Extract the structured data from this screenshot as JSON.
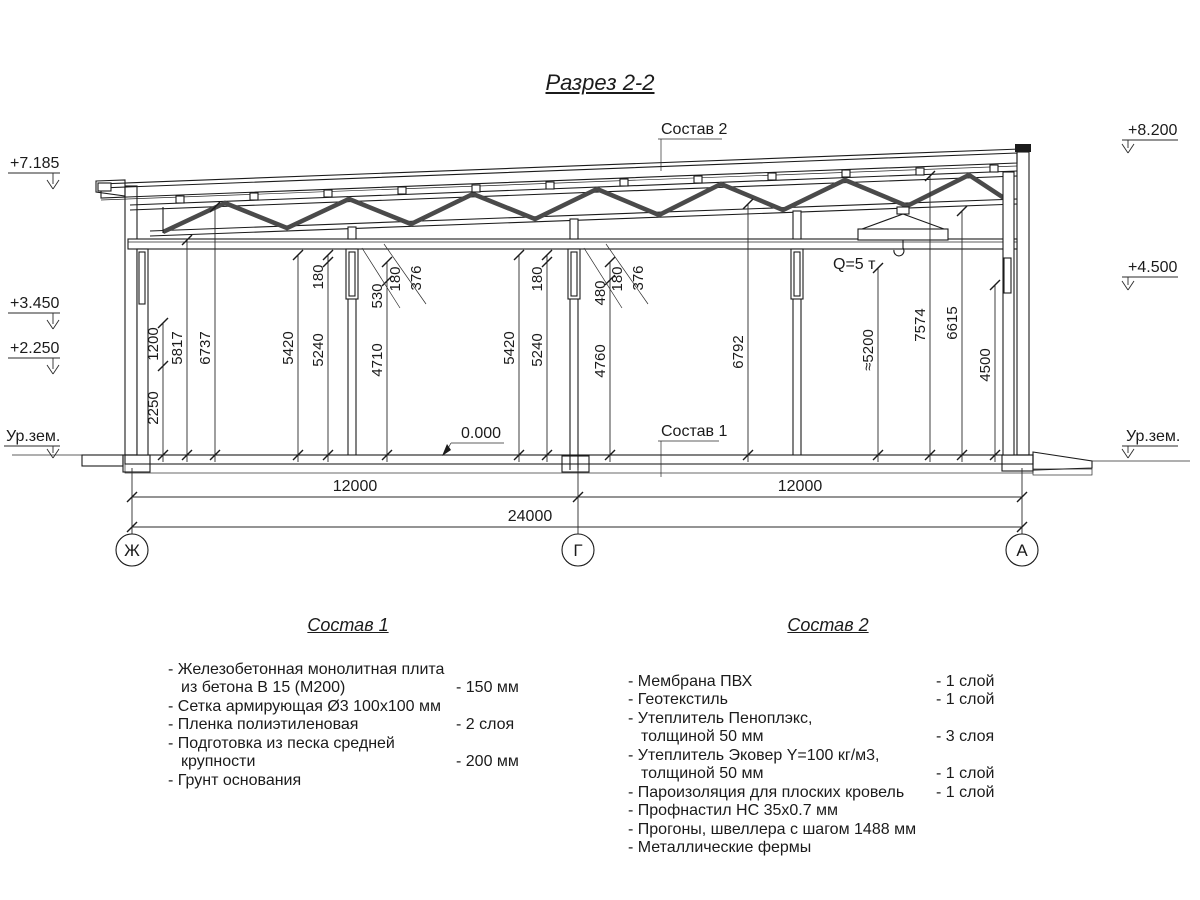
{
  "title": "Разрез 2-2",
  "drawing": {
    "callout_top": "Состав 2",
    "callout_floor": "Состав 1",
    "zero_mark": "0.000",
    "crane_label": "Q=5 т",
    "elev": {
      "l1": "+7.185",
      "l2": "+3.450",
      "l3": "+2.250",
      "l4": "Ур.зем.",
      "r1": "+8.200",
      "r2": "+4.500",
      "r3": "Ур.зем."
    },
    "vdims": {
      "d1200": "1200",
      "d2250": "2250",
      "d5817": "5817",
      "d6737": "6737",
      "d5420a": "5420",
      "d180a": "180",
      "d5240a": "5240",
      "d530": "530",
      "d4710": "4710",
      "lead180a": "180",
      "lead376a": "376",
      "d5420b": "5420",
      "d180b": "180",
      "d5240b": "5240",
      "d480": "480",
      "d4760": "4760",
      "lead180b": "180",
      "lead376b": "376",
      "d6792": "6792",
      "d5200": "≈5200",
      "d7574": "7574",
      "d6615": "6615",
      "d4500": "4500"
    },
    "hdims": {
      "bay1": "12000",
      "bay2": "12000",
      "total": "24000"
    },
    "axes": {
      "a1": "Ж",
      "a2": "Г",
      "a3": "А"
    }
  },
  "legend1": {
    "heading": "Состав 1",
    "items": [
      {
        "lines": [
          "- Железобетонная  монолитная плита",
          "из бетона В 15 (М200)"
        ],
        "value": "- 150 мм"
      },
      {
        "lines": [
          "- Сетка армирующая Ø3 100х100 мм"
        ],
        "value": ""
      },
      {
        "lines": [
          "- Пленка полиэтиленовая"
        ],
        "value": "- 2 слоя"
      },
      {
        "lines": [
          "- Подготовка из песка средней",
          "крупности"
        ],
        "value": "- 200 мм"
      },
      {
        "lines": [
          "- Грунт основания"
        ],
        "value": ""
      }
    ]
  },
  "legend2": {
    "heading": "Состав 2",
    "items": [
      {
        "lines": [
          "- Мембрана ПВХ"
        ],
        "value": "- 1 слой"
      },
      {
        "lines": [
          "- Геотекстиль"
        ],
        "value": "- 1 слой"
      },
      {
        "lines": [
          "- Утеплитель Пеноплэкс,",
          "толщиной 50 мм"
        ],
        "value": "- 3 слоя"
      },
      {
        "lines": [
          "- Утеплитель Эковер Y=100 кг/м3,",
          "толщиной 50 мм"
        ],
        "value": "- 1 слой"
      },
      {
        "lines": [
          "- Пароизоляция для плоских кровель"
        ],
        "value": "- 1 слой"
      },
      {
        "lines": [
          "- Профнастил НС 35х0.7 мм"
        ],
        "value": ""
      },
      {
        "lines": [
          "- Прогоны, швеллера с шагом 1488 мм"
        ],
        "value": ""
      },
      {
        "lines": [
          "- Металлические фермы"
        ],
        "value": ""
      }
    ]
  }
}
